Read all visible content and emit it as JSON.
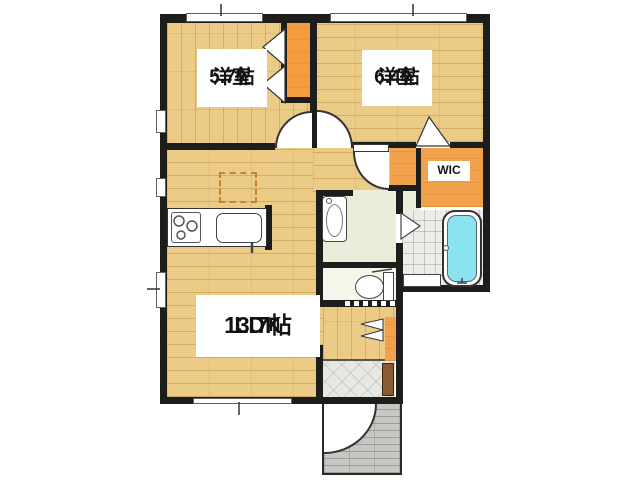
{
  "floorplan": {
    "rooms": {
      "bedroom1": {
        "name": "洋室",
        "size": "5.7帖"
      },
      "bedroom2": {
        "name": "洋室",
        "size": "6.4帖"
      },
      "ldk": {
        "name": "LDK",
        "size": "13.7帖"
      },
      "wic": {
        "name": "WIC"
      }
    },
    "colors": {
      "wall": "#1d1d1b",
      "wood_floor": "#eccb86",
      "closet_orange": "#f2a14c",
      "washroom_green": "#e9edda",
      "bath_water": "#8be3ef",
      "genkan_tile": "#e7e7e3",
      "porch_tile": "#c6c6c2",
      "entry_cabinet_brown": "#8a5a33"
    }
  }
}
